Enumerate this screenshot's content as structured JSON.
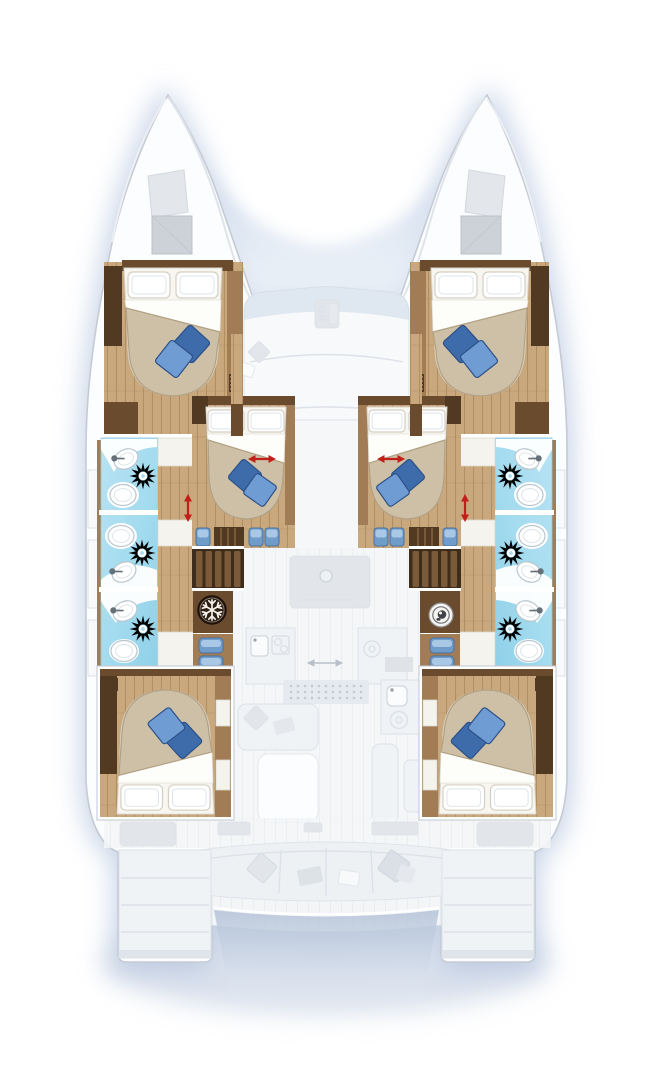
{
  "document": {
    "label": "Catamaran yacht deck floor plan, bow up, six double cabins and six bathrooms",
    "type": "floor-plan"
  },
  "colors": {
    "bg": "#ffffff",
    "glow": "#a3b8d8",
    "notch": "#b6c8e2",
    "hull-fill": "#fcfdfe",
    "hull-stroke": "#c5cbd4",
    "ghost-fill": "#f0f3f6",
    "ghost-dark": "#e2e6ea",
    "ghost-stroke": "#dde2e8",
    "wood-light": "#c9a87d",
    "wood-grain": "#b28e61",
    "wood-mid": "#a27c54",
    "wood-dark": "#6b4b2e",
    "wood-darker": "#523a22",
    "bath-blue": "#a9ddf0",
    "bath-blue-deep": "#90d0e8",
    "fixture-stroke": "#b9c6ce",
    "bed-white": "#f7f6f1",
    "bed-beige": "#cec0a6",
    "bed-beige-edge": "#b0a084",
    "pillow-stroke": "#d4cfc3",
    "cushion-dark": "#3e6cab",
    "cushion-light": "#6f9cd3",
    "cushion-stroke": "#2c5187",
    "arrow-red": "#c1201a",
    "icon-dark": "#2d1f12",
    "icon-light": "#f4f1ec"
  },
  "inventory": {
    "double_berth_cabins": 6,
    "forward_hull_cabins": 2,
    "nacelle_cabins": 2,
    "aft_hull_cabins": 2,
    "bathrooms": 6,
    "shower_units": 6,
    "blue_throw_pillows_per_bed": 2
  },
  "icons": [
    {
      "name": "snowflake-freezer-icon",
      "side": "port"
    },
    {
      "name": "washing-machine-icon",
      "side": "starboard"
    },
    {
      "name": "shower-sunburst-icon",
      "count": 6
    },
    {
      "name": "sink-faucet-icon",
      "count": 6
    },
    {
      "name": "toilet-icon",
      "count": 6
    }
  ],
  "annotations": {
    "red_slide_arrows_horizontal": 2,
    "red_slide_arrows_vertical": 2,
    "gray_aisle_arrow": 1
  }
}
